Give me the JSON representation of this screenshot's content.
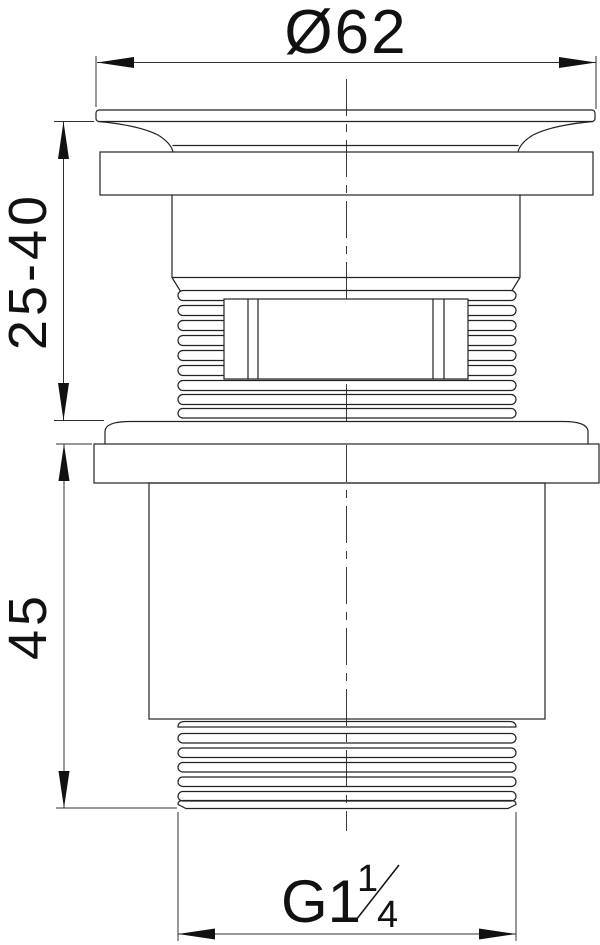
{
  "drawing": {
    "component": "basin-waste-valve-side-elevation",
    "background": "#ffffff",
    "line_color": "#232323",
    "dimensions": {
      "top_diameter": {
        "label": "Ø62",
        "kind": "diameter"
      },
      "upper_height_range": {
        "label": "25-40",
        "kind": "adjustable-height"
      },
      "body_height": {
        "label": "45",
        "kind": "height"
      },
      "thread": {
        "label": "G1¼",
        "main": "G1",
        "numerator": "1",
        "denominator": "4",
        "kind": "thread-designation"
      }
    }
  }
}
